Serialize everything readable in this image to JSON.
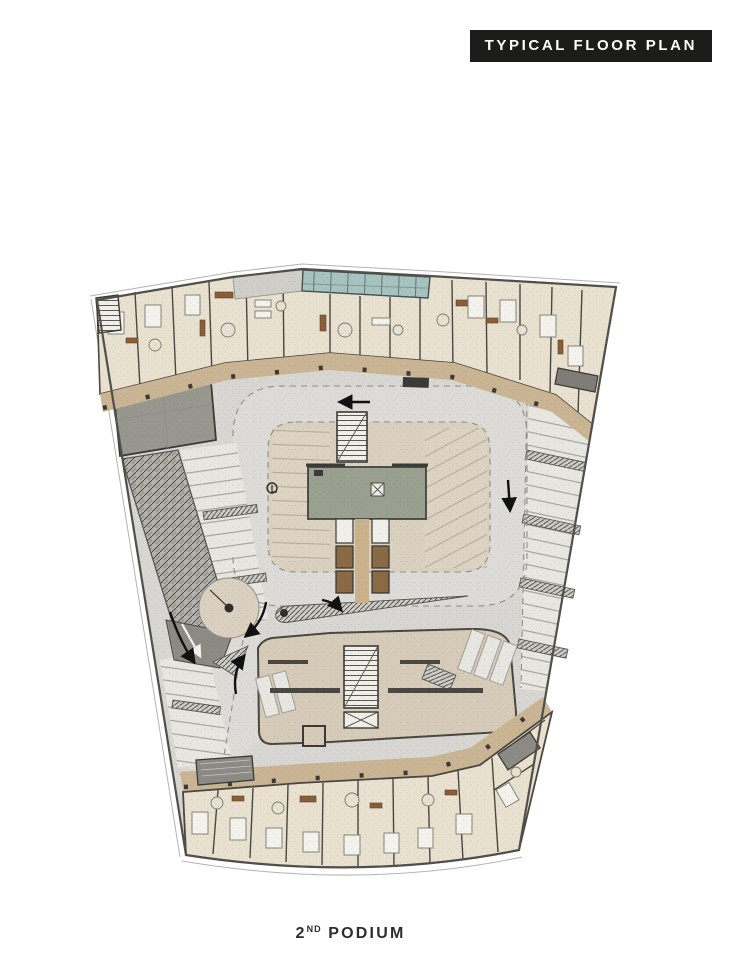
{
  "header": {
    "title": "TYPICAL FLOOR PLAN"
  },
  "caption": {
    "number": "2",
    "ordinal": "ND",
    "word": "PODIUM"
  },
  "plan": {
    "kind": "architectural-floor-plan",
    "level_shown": "2nd Podium",
    "colors": {
      "page_bg": "#ffffff",
      "banner_bg": "#1c1c1a",
      "banner_text": "#ffffff",
      "caption_text": "#2d2d2b",
      "parking_floor": "#d7d6d2",
      "drive_aisle": "#dcdbd7",
      "inner_parking": "#dad0c0",
      "apartment_floor": "#e9e1cf",
      "corridor": "#c9b593",
      "amenity_room": "#d6cbb8",
      "pool": "#a6c3c0",
      "walkway": "#cfcec9",
      "core_plant": "#9aa08f",
      "core_light": "#f0efe9",
      "lobby": "#c9b28c",
      "elevator_cab": "#8a6a45",
      "service_dark": "#98978f",
      "ramp": "#b3b2ac",
      "ramp_dark": "#8b8a84",
      "stall_bed": "#e8e6e1",
      "wall": "#3b3a36",
      "outline": "#514f4a",
      "balcony_line": "#b5b3ad"
    },
    "zones": {
      "north_residential": "residential units (top band)",
      "south_residential": "residential units (bottom band)",
      "pool_terrace": "pool / skylight terrace",
      "parking_loop": "parking drive-aisle loop",
      "perimeter_stalls": "perimeter parking stalls",
      "spiral_ramp": "car ramp",
      "roundabout": "turning circle",
      "north_core": "stair core",
      "plant_room": "central services room",
      "elevator_lobby": "elevator lobby",
      "south_core": "stair and elevator core",
      "amenity": "lower amenity / back-of-house room"
    }
  }
}
